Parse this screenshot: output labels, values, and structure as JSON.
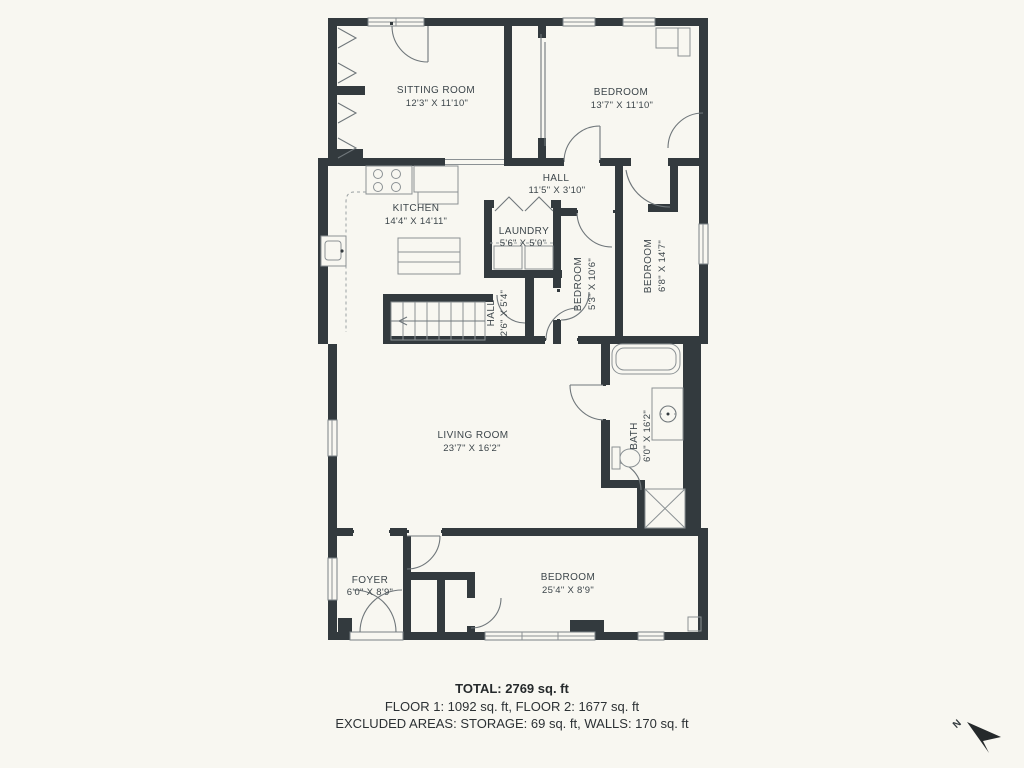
{
  "colors": {
    "background": "#f8f7f1",
    "wall": "#333a3e",
    "thin_line": "#8b9194",
    "label_text": "#3d464b",
    "summary_text": "#25292b"
  },
  "rooms": [
    {
      "id": "sitting-room",
      "name": "SITTING ROOM",
      "dims": "12'3\" X 11'10\""
    },
    {
      "id": "bedroom-top",
      "name": "BEDROOM",
      "dims": "13'7\" X 11'10\""
    },
    {
      "id": "hall-upper",
      "name": "HALL",
      "dims": "11'5\" X 3'10\""
    },
    {
      "id": "kitchen",
      "name": "KITCHEN",
      "dims": "14'4\" X 14'11\""
    },
    {
      "id": "laundry",
      "name": "LAUNDRY",
      "dims": "5'6\" X 5'0\""
    },
    {
      "id": "hall-stairs",
      "name": "HALL",
      "dims": "2'6\" X 5'4\""
    },
    {
      "id": "bedroom-small",
      "name": "BEDROOM",
      "dims": "5'3\" X 10'6\""
    },
    {
      "id": "bedroom-right",
      "name": "BEDROOM",
      "dims": "6'8\" X 14'7\""
    },
    {
      "id": "living-room",
      "name": "LIVING ROOM",
      "dims": "23'7\" X 16'2\""
    },
    {
      "id": "bath",
      "name": "BATH",
      "dims": "6'0\" X 16'2\""
    },
    {
      "id": "foyer",
      "name": "FOYER",
      "dims": "6'0\" X 8'9\""
    },
    {
      "id": "bedroom-bottom",
      "name": "BEDROOM",
      "dims": "25'4\" X 8'9\""
    }
  ],
  "summary": {
    "total": "TOTAL: 2769 sq. ft",
    "floors": "FLOOR 1: 1092 sq. ft, FLOOR 2: 1677 sq. ft",
    "excluded": "EXCLUDED AREAS: STORAGE: 69 sq. ft, WALLS: 170 sq. ft"
  },
  "compass": {
    "north": "N"
  }
}
